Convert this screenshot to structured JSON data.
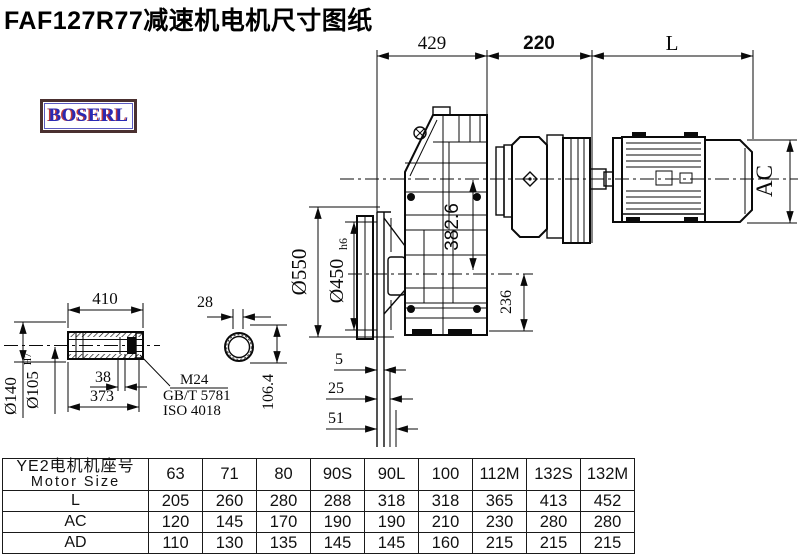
{
  "title": "FAF127R77减速机电机尺寸图纸",
  "logo": {
    "text": "BOSERL"
  },
  "colors": {
    "line": "#0a0a0a",
    "logo_text": "#2a2ab4",
    "logo_border": "#4a3030",
    "logo_accent": "#c23b3b"
  },
  "drawing": {
    "top_dims": {
      "d429": "429",
      "d220": "220",
      "dL": "L"
    },
    "motor": {
      "ac": "AC"
    },
    "gearbox": {
      "flange_od": "Ø550",
      "spigot_d": "Ø450",
      "spigot_tol": "h6",
      "center_dist": "382.6",
      "base_height": "236"
    },
    "flange_steps": {
      "s5": "5",
      "s25": "25",
      "s51": "51"
    },
    "shaft": {
      "length": "410",
      "hub_od": "Ø140",
      "bore_d": "Ø105",
      "bore_tol": "H7",
      "l38": "38",
      "l373": "373",
      "thread": "M24",
      "std_gb": "GB/T 5781",
      "std_iso": "ISO 4018",
      "key_w": "28",
      "key_h": "106.4"
    }
  },
  "table": {
    "header_line1": "YE2电机机座号",
    "header_line2": "Motor Size",
    "columns": [
      "63",
      "71",
      "80",
      "90S",
      "90L",
      "100",
      "112M",
      "132S",
      "132M"
    ],
    "rows": [
      {
        "label": "L",
        "values": [
          "205",
          "260",
          "280",
          "288",
          "318",
          "318",
          "365",
          "413",
          "452"
        ]
      },
      {
        "label": "AC",
        "values": [
          "120",
          "145",
          "170",
          "190",
          "190",
          "210",
          "230",
          "280",
          "280"
        ]
      },
      {
        "label": "AD",
        "values": [
          "110",
          "130",
          "135",
          "145",
          "145",
          "160",
          "215",
          "215",
          "215"
        ]
      }
    ]
  }
}
